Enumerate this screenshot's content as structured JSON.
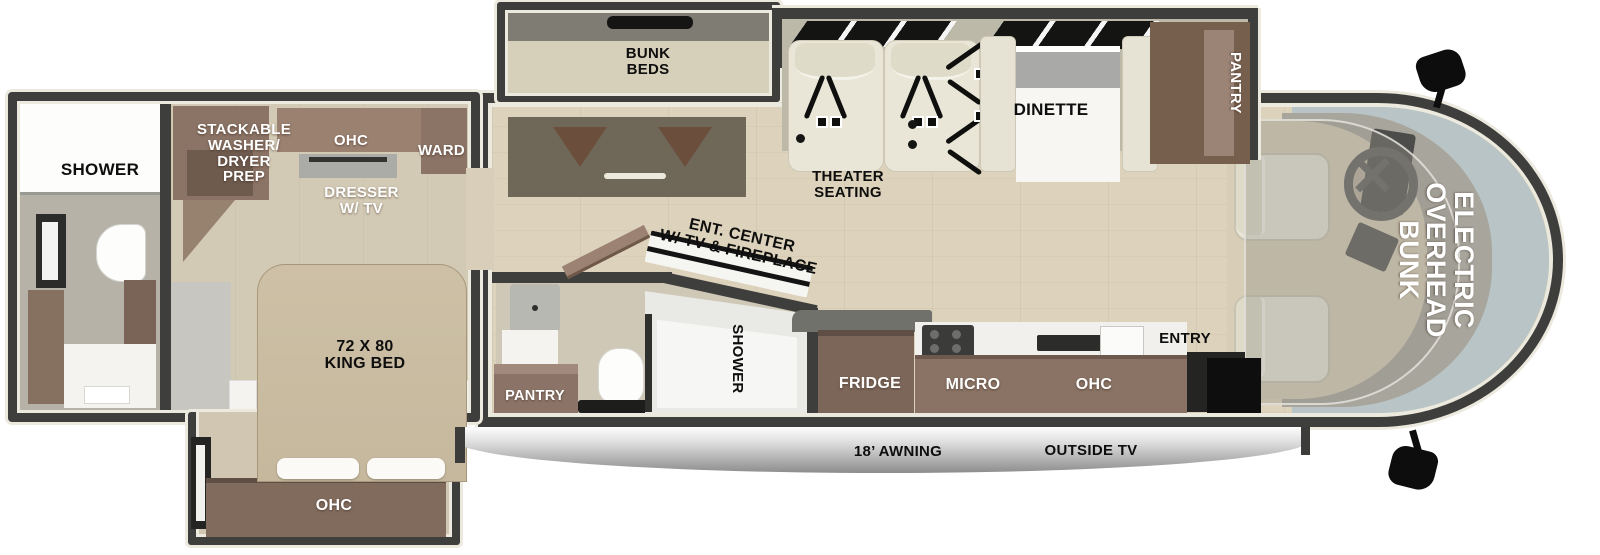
{
  "title": "Class A Motorhome Floor Plan",
  "palette": {
    "wall": "#3e3e3c",
    "lining": "#eceadf",
    "wood_floor": "#ddd2bb",
    "cabinet_brown": "#8a7365",
    "pantry_brown": "#775f4e",
    "bed_tan": "#c9bca2",
    "seat_cream": "#e9e6d8",
    "windshield": "#b8c4c5",
    "awning_silver": "#c9c9c9",
    "label_black": "#0e0e0e",
    "label_white": "#ffffff"
  },
  "rooms": {
    "rear_bath": {
      "shower_label": "SHOWER"
    },
    "bedroom": {
      "washer_dryer_label": "STACKABLE\nWASHER/\nDRYER\nPREP",
      "ohc_label": "OHC",
      "ward_label": "WARD",
      "dresser_label": "DRESSER\nW/ TV",
      "bed_label": "72 X 80\nKING BED",
      "slide_ohc_label": "OHC"
    },
    "bunk_slide": {
      "label": "BUNK\nBEDS"
    },
    "living": {
      "theater_label": "THEATER\nSEATING",
      "dinette_label": "DINETTE",
      "pantry_label": "PANTRY",
      "ent_center_label": "ENT. CENTER\nW/ TV & FIREPLACE"
    },
    "mid_bath": {
      "pantry_label": "PANTRY",
      "shower_label": "SHOWER"
    },
    "kitchen": {
      "fridge_label": "FRIDGE",
      "micro_label": "MICRO",
      "ohc_label": "OHC",
      "entry_label": "ENTRY"
    },
    "cab": {
      "overhead_bunk_label": "ELECTRIC\nOVERHEAD\nBUNK"
    },
    "exterior": {
      "awning_label": "18’ AWNING",
      "outside_tv_label": "OUTSIDE TV"
    }
  }
}
